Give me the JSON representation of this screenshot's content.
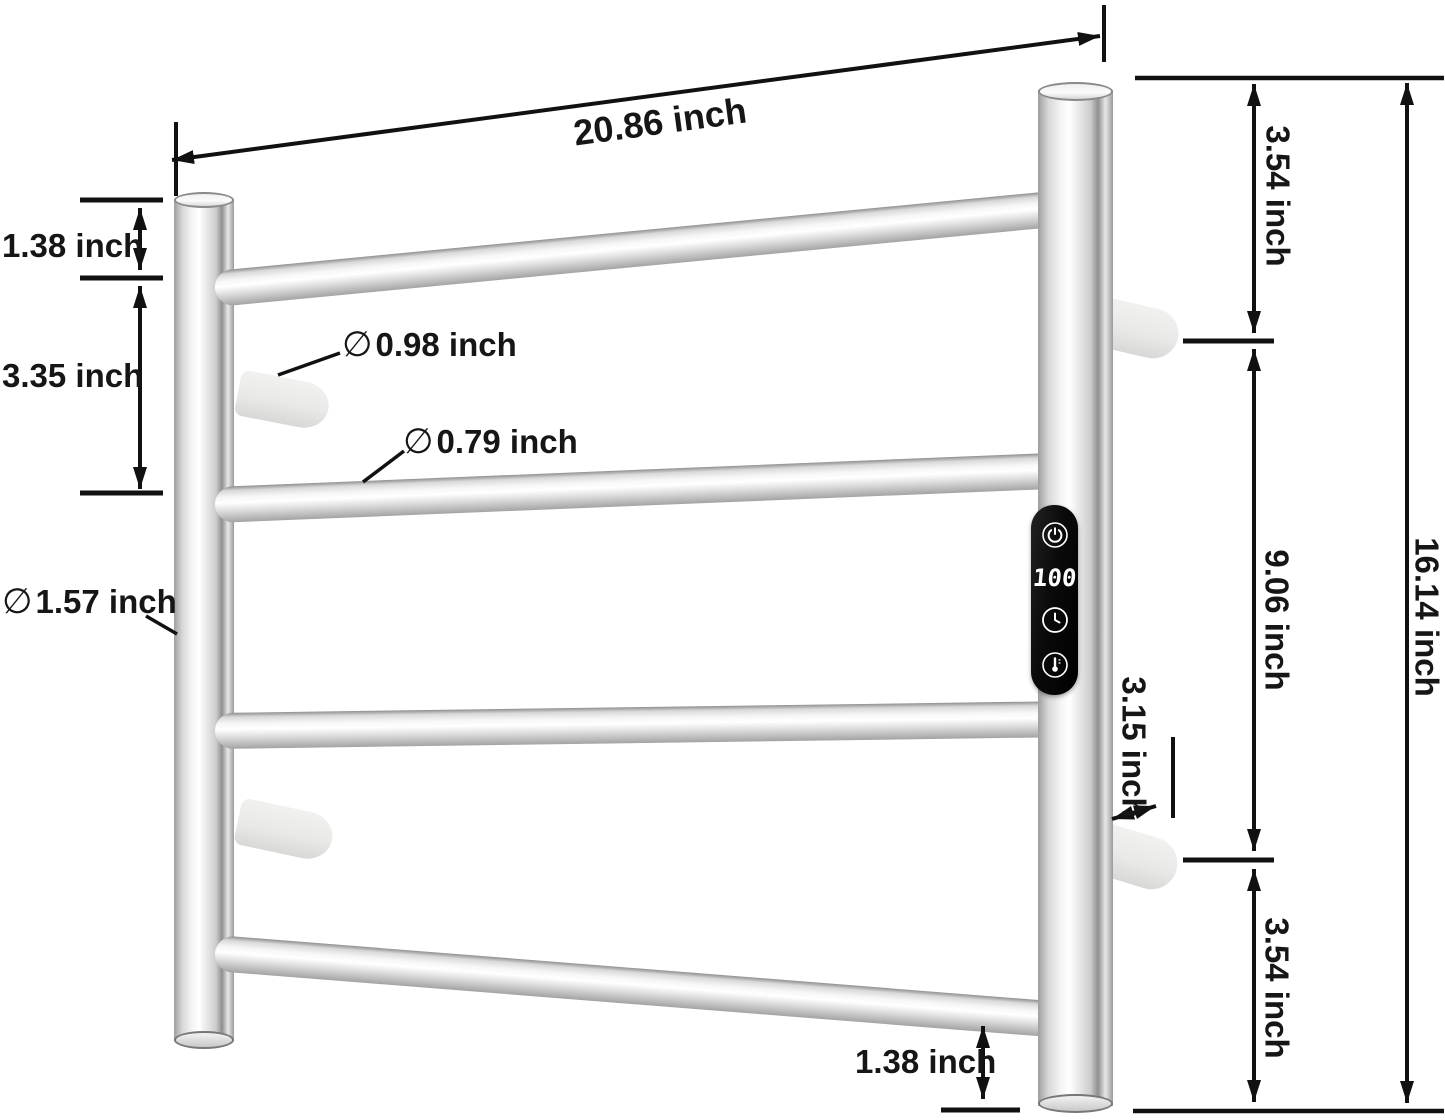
{
  "figure": {
    "type": "product dimension diagram",
    "product": "wall-mounted heated towel rack (4-bar ladder) with touch control panel"
  },
  "annotations": {
    "width_top": "20.86 inch",
    "gap_top_left": "1.38 inch",
    "rung_spacing_left": "3.35 inch",
    "hook_diameter": {
      "symbol": "∅",
      "text": "0.98 inch"
    },
    "rung_diameter": {
      "symbol": "∅",
      "text": "0.79 inch"
    },
    "post_diameter": {
      "symbol": "∅",
      "text": "1.57 inch"
    },
    "right_top_gap": "3.54 inch",
    "right_middle_span": "9.06 inch",
    "wall_offset": "3.15 inch",
    "right_bottom_gap": "3.54 inch",
    "total_height": "16.14 inch",
    "gap_bottom": "1.38 inch"
  },
  "control_panel": {
    "display_value": "100",
    "icons": [
      "power-icon",
      "clock-icon",
      "thermometer-icon"
    ]
  },
  "colors": {
    "background": "#ffffff",
    "dimension_lines": "#111111",
    "metal_highlight": "#ffffff",
    "metal_shadow": "#8f8f8f",
    "standoff": "#e9e9e7",
    "panel_background": "#0a0a0a",
    "panel_foreground": "#ffffff"
  }
}
